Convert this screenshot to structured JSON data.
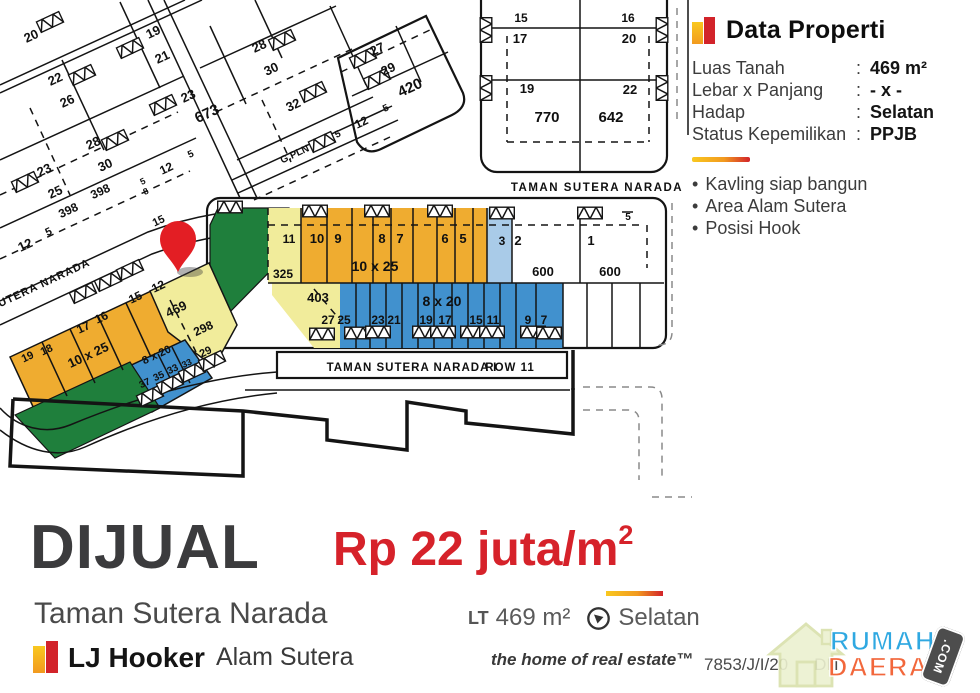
{
  "colors": {
    "lot_orange": "#EFAC30",
    "lot_yellow": "#F1EC9B",
    "lot_blue": "#4191CE",
    "lot_lightblue": "#A9CBE8",
    "lot_green": "#1F7F3C",
    "pin_red": "#E31E24",
    "price_red": "#D6222A",
    "brand_yellow": "#F9C81F",
    "brand_orange": "#F29A1F",
    "brand_red": "#D2232A",
    "wm_blue": "#2FA8E1",
    "wm_orange": "#F2673B"
  },
  "panel": {
    "title": "Data Properti",
    "rows": [
      {
        "label": "Luas Tanah",
        "value": "469 m²"
      },
      {
        "label": "Lebar x Panjang",
        "value": "- x -"
      },
      {
        "label": "Hadap",
        "value": "Selatan"
      },
      {
        "label": "Status Kepemilikan",
        "value": "PPJB"
      }
    ],
    "bullets": [
      "Kavling siap bangun",
      "Area Alam Sutera",
      "Posisi Hook"
    ]
  },
  "listing": {
    "status": "DIJUAL",
    "location": "Taman Sutera Narada",
    "price_main": "Rp 22 juta/m",
    "price_sup": "2",
    "lt_label": "LT",
    "lt_value": "469 m²",
    "facing": "Selatan",
    "agency": "LJ Hooker",
    "office": "Alam Sutera",
    "tagline": "the home of real estate™",
    "ref_left": "7853/J/I/20",
    "ref_right": "DIT"
  },
  "watermark": {
    "word1": "RUMAH",
    "word2": "DAERAH",
    "tag": ".COM"
  },
  "map": {
    "labels": [
      {
        "t": "20",
        "x": 33,
        "y": 40,
        "s": 13,
        "r": -25
      },
      {
        "t": "19",
        "x": 155,
        "y": 36,
        "s": 13,
        "r": -25
      },
      {
        "t": "21",
        "x": 164,
        "y": 61,
        "s": 13,
        "r": -25
      },
      {
        "t": "22",
        "x": 57,
        "y": 83,
        "s": 13,
        "r": -25
      },
      {
        "t": "26",
        "x": 69,
        "y": 105,
        "s": 13,
        "r": -25
      },
      {
        "t": "23",
        "x": 190,
        "y": 100,
        "s": 13,
        "r": -25
      },
      {
        "t": "673",
        "x": 209,
        "y": 118,
        "s": 15,
        "r": -25
      },
      {
        "t": "28",
        "x": 261,
        "y": 50,
        "s": 13,
        "r": -25
      },
      {
        "t": "30",
        "x": 273,
        "y": 73,
        "s": 13,
        "r": -25
      },
      {
        "t": "32",
        "x": 295,
        "y": 109,
        "s": 13,
        "r": -25
      },
      {
        "t": "G.PLN",
        "x": 296,
        "y": 157,
        "s": 10,
        "r": -25
      },
      {
        "t": "28",
        "x": 95,
        "y": 147,
        "s": 13,
        "r": -25
      },
      {
        "t": "30",
        "x": 107,
        "y": 169,
        "s": 13,
        "r": -25
      },
      {
        "t": "5",
        "x": 192,
        "y": 157,
        "s": 10,
        "r": -25
      },
      {
        "t": "12",
        "x": 168,
        "y": 172,
        "s": 12,
        "r": -25
      },
      {
        "t": "5",
        "x": 144,
        "y": 184,
        "s": 9,
        "r": -25
      },
      {
        "t": "8",
        "x": 147,
        "y": 194,
        "s": 9,
        "r": -25
      },
      {
        "t": "23",
        "x": 46,
        "y": 174,
        "s": 13,
        "r": -25
      },
      {
        "t": "25",
        "x": 57,
        "y": 196,
        "s": 13,
        "r": -25
      },
      {
        "t": "398",
        "x": 102,
        "y": 195,
        "s": 12,
        "r": -25
      },
      {
        "t": "398",
        "x": 70,
        "y": 214,
        "s": 12,
        "r": -25
      },
      {
        "t": "15",
        "x": 160,
        "y": 224,
        "s": 11,
        "r": -25
      },
      {
        "t": "5",
        "x": 50,
        "y": 235,
        "s": 11,
        "r": -25
      },
      {
        "t": "12",
        "x": 27,
        "y": 249,
        "s": 13,
        "r": -25
      },
      {
        "t": "27",
        "x": 379,
        "y": 53,
        "s": 13,
        "r": -25
      },
      {
        "t": "29",
        "x": 390,
        "y": 73,
        "s": 13,
        "r": -25
      },
      {
        "t": "420",
        "x": 412,
        "y": 92,
        "s": 15,
        "r": -25
      },
      {
        "t": "5",
        "x": 387,
        "y": 111,
        "s": 10,
        "r": -25
      },
      {
        "t": "12",
        "x": 363,
        "y": 126,
        "s": 12,
        "r": -25
      },
      {
        "t": "5",
        "x": 339,
        "y": 137,
        "s": 10,
        "r": -25
      },
      {
        "t": "15",
        "x": 521,
        "y": 22,
        "s": 12
      },
      {
        "t": "16",
        "x": 628,
        "y": 22,
        "s": 12
      },
      {
        "t": "17",
        "x": 520,
        "y": 43,
        "s": 13
      },
      {
        "t": "20",
        "x": 629,
        "y": 43,
        "s": 13
      },
      {
        "t": "19",
        "x": 527,
        "y": 93,
        "s": 13
      },
      {
        "t": "22",
        "x": 630,
        "y": 94,
        "s": 13
      },
      {
        "t": "770",
        "x": 547,
        "y": 122,
        "s": 15
      },
      {
        "t": "642",
        "x": 611,
        "y": 122,
        "s": 15
      },
      {
        "t": "TAMAN SUTERA NARADA",
        "x": 597,
        "y": 191,
        "s": 11.5,
        "sp": 1.5
      },
      {
        "t": "11",
        "x": 289,
        "y": 243,
        "s": 12
      },
      {
        "t": "325",
        "x": 283,
        "y": 278,
        "s": 12
      },
      {
        "t": "10",
        "x": 317,
        "y": 243,
        "s": 13
      },
      {
        "t": "9",
        "x": 338,
        "y": 243,
        "s": 13
      },
      {
        "t": "8",
        "x": 382,
        "y": 243,
        "s": 13
      },
      {
        "t": "7",
        "x": 400,
        "y": 243,
        "s": 13
      },
      {
        "t": "6",
        "x": 445,
        "y": 243,
        "s": 13
      },
      {
        "t": "5",
        "x": 463,
        "y": 243,
        "s": 13
      },
      {
        "t": "10 x 25",
        "x": 375,
        "y": 271,
        "s": 14
      },
      {
        "t": "3",
        "x": 502,
        "y": 245,
        "s": 12
      },
      {
        "t": "2",
        "x": 518,
        "y": 245,
        "s": 13
      },
      {
        "t": "600",
        "x": 543,
        "y": 276,
        "s": 13
      },
      {
        "t": "1",
        "x": 591,
        "y": 245,
        "s": 13
      },
      {
        "t": "600",
        "x": 610,
        "y": 276,
        "s": 13
      },
      {
        "t": "5",
        "x": 628,
        "y": 220,
        "s": 10
      },
      {
        "t": "403",
        "x": 318,
        "y": 302,
        "s": 13
      },
      {
        "t": "8 x 20",
        "x": 442,
        "y": 306,
        "s": 14
      },
      {
        "t": "27",
        "x": 328,
        "y": 324,
        "s": 12
      },
      {
        "t": "25",
        "x": 344,
        "y": 324,
        "s": 12
      },
      {
        "t": "23",
        "x": 378,
        "y": 324,
        "s": 12
      },
      {
        "t": "21",
        "x": 394,
        "y": 324,
        "s": 12
      },
      {
        "t": "19",
        "x": 426,
        "y": 324,
        "s": 12
      },
      {
        "t": "17",
        "x": 445,
        "y": 324,
        "s": 12
      },
      {
        "t": "15",
        "x": 476,
        "y": 324,
        "s": 12
      },
      {
        "t": "11",
        "x": 493,
        "y": 324,
        "s": 12
      },
      {
        "t": "9",
        "x": 528,
        "y": 324,
        "s": 12
      },
      {
        "t": "7",
        "x": 544,
        "y": 324,
        "s": 12
      },
      {
        "t": "TAMAN SUTERA NARADA I",
        "x": 412,
        "y": 371,
        "s": 11.5,
        "sp": 1
      },
      {
        "t": "ROW 11",
        "x": 510,
        "y": 371,
        "s": 11.5,
        "sp": 1
      },
      {
        "t": "TAMAN SUTERA NARADA",
        "x": 20,
        "y": 298,
        "s": 11,
        "r": -25,
        "sp": 1
      },
      {
        "t": "19",
        "x": 29,
        "y": 360,
        "s": 11,
        "r": -25
      },
      {
        "t": "18",
        "x": 48,
        "y": 353,
        "s": 11,
        "r": -25
      },
      {
        "t": "17",
        "x": 85,
        "y": 331,
        "s": 12,
        "r": -25
      },
      {
        "t": "16",
        "x": 103,
        "y": 321,
        "s": 12,
        "r": -25
      },
      {
        "t": "15",
        "x": 137,
        "y": 301,
        "s": 12,
        "r": -25
      },
      {
        "t": "12",
        "x": 160,
        "y": 290,
        "s": 12,
        "r": -25
      },
      {
        "t": "469",
        "x": 178,
        "y": 313,
        "s": 13,
        "r": -25
      },
      {
        "t": "298",
        "x": 205,
        "y": 332,
        "s": 12,
        "r": -25
      },
      {
        "t": "29",
        "x": 207,
        "y": 355,
        "s": 11,
        "r": -25
      },
      {
        "t": "33",
        "x": 188,
        "y": 366,
        "s": 9,
        "r": -25
      },
      {
        "t": "10 x 25",
        "x": 90,
        "y": 359,
        "s": 13,
        "r": -25
      },
      {
        "t": "8 x 20",
        "x": 158,
        "y": 358,
        "s": 11,
        "r": -25
      },
      {
        "t": "37",
        "x": 146,
        "y": 386,
        "s": 10,
        "r": -25
      },
      {
        "t": "35",
        "x": 160,
        "y": 379,
        "s": 10,
        "r": -25
      },
      {
        "t": "33",
        "x": 174,
        "y": 372,
        "s": 10,
        "r": -25
      }
    ]
  }
}
